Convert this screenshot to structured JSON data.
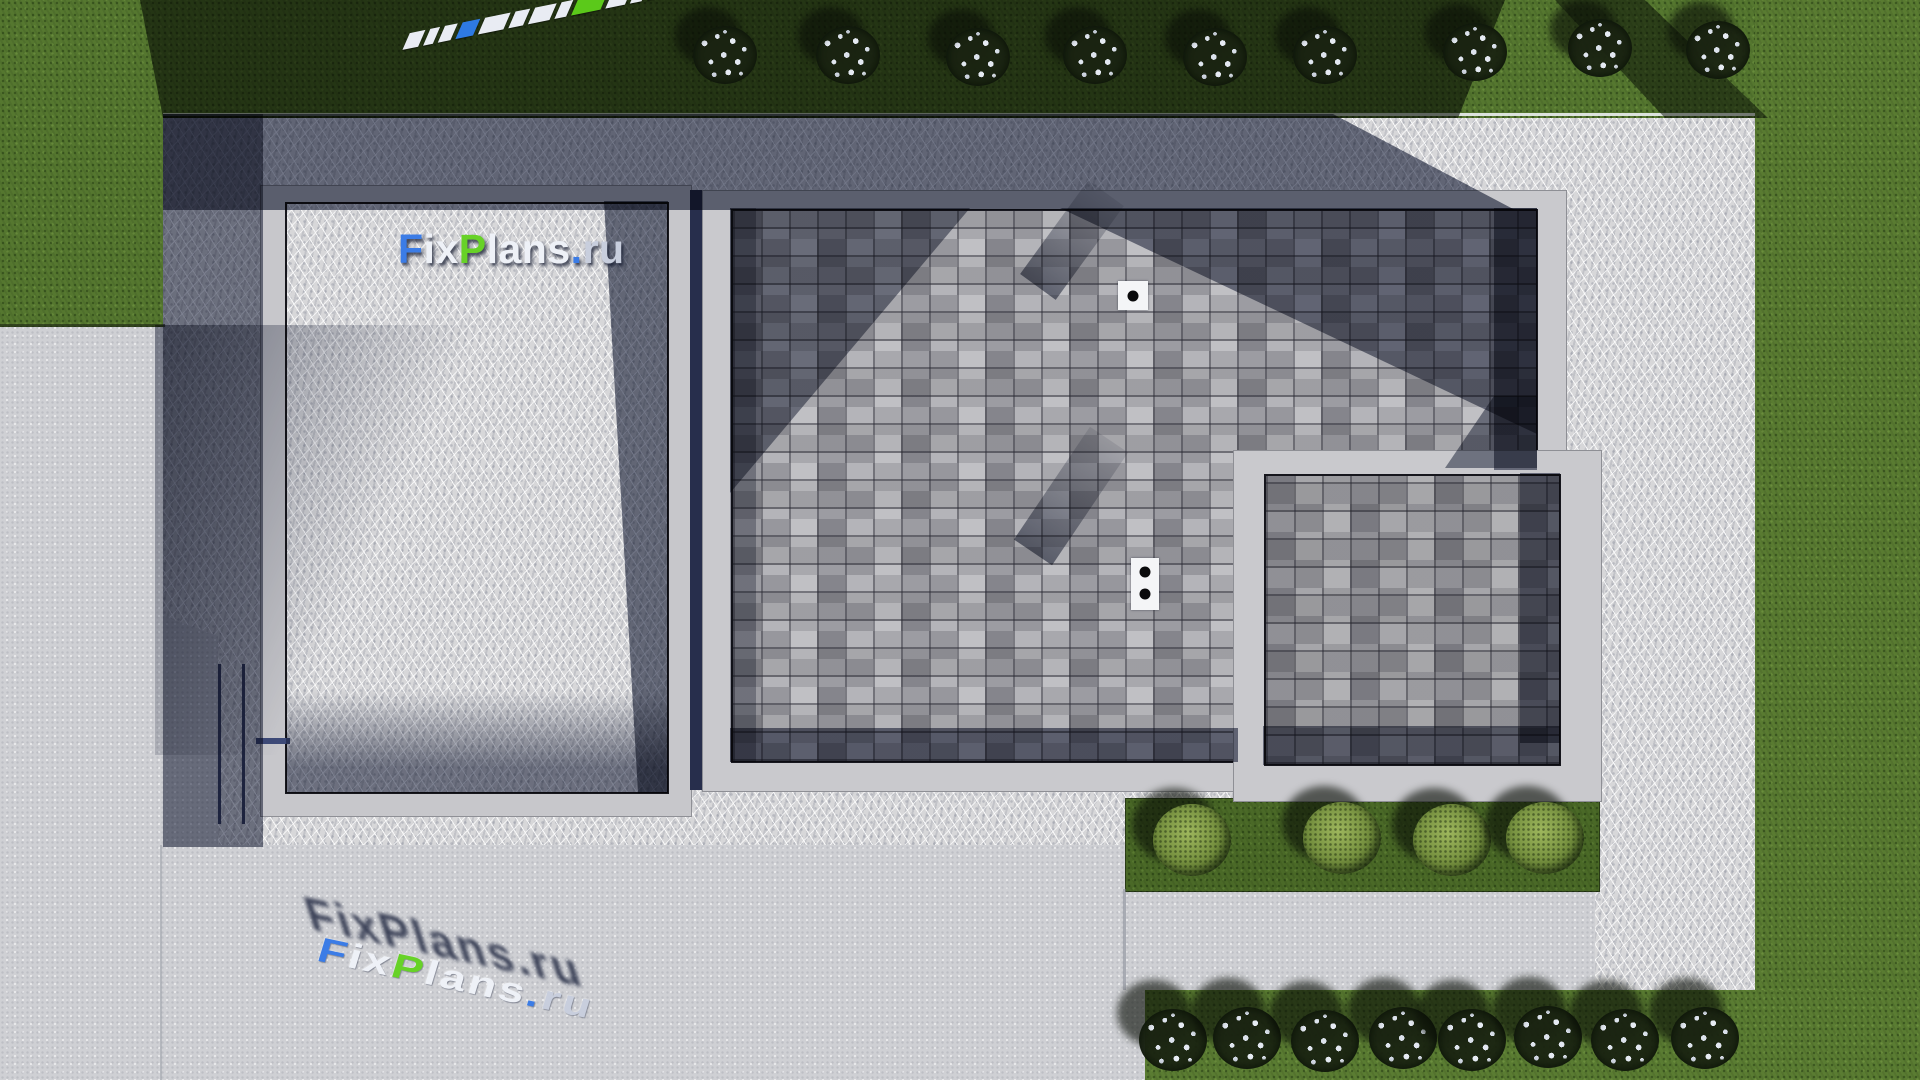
{
  "watermark": {
    "text": "FixPlans.ru",
    "colors": {
      "blue": "#3b7ce6",
      "green": "#67d227",
      "white": "#eef1f7",
      "silver": "#c8cedd",
      "shadow": "rgba(27,34,60,0.82)"
    },
    "segments": [
      {
        "t": "F",
        "c": "blue"
      },
      {
        "t": "ix",
        "c": "white"
      },
      {
        "t": "P",
        "c": "green"
      },
      {
        "t": "lans",
        "c": "white"
      },
      {
        "t": ".",
        "c": "blue"
      },
      {
        "t": "ru",
        "c": "silver"
      }
    ]
  },
  "palette": {
    "grass_sunlit": "#57782f",
    "grass_shadowed": "#202c15",
    "concrete_pavement": "#cfd0d4",
    "gravel_sunlit": "#d8d8da",
    "gravel_shadowed": "#49537a",
    "parapet_wall": "#c7c7cb",
    "paver_light": "#b4b4b9",
    "paver_mid": "#98989e",
    "shadow_blue": "#1f2a4e",
    "vent_white": "#f4f5f7"
  },
  "scene": {
    "flower_bushes_top": [
      {
        "x": 725,
        "y": 55
      },
      {
        "x": 848,
        "y": 55
      },
      {
        "x": 978,
        "y": 57
      },
      {
        "x": 1095,
        "y": 55
      },
      {
        "x": 1215,
        "y": 57
      },
      {
        "x": 1325,
        "y": 55
      },
      {
        "x": 1475,
        "y": 52
      },
      {
        "x": 1600,
        "y": 48
      },
      {
        "x": 1718,
        "y": 50
      }
    ],
    "flower_bushes_bottom": [
      {
        "x": 1173,
        "y": 1040
      },
      {
        "x": 1247,
        "y": 1038
      },
      {
        "x": 1325,
        "y": 1041
      },
      {
        "x": 1403,
        "y": 1038
      },
      {
        "x": 1472,
        "y": 1040
      },
      {
        "x": 1548,
        "y": 1037
      },
      {
        "x": 1625,
        "y": 1040
      },
      {
        "x": 1705,
        "y": 1038
      }
    ],
    "shrubs": [
      {
        "x": 1192,
        "y": 840
      },
      {
        "x": 1342,
        "y": 838
      },
      {
        "x": 1452,
        "y": 840
      },
      {
        "x": 1545,
        "y": 838
      }
    ],
    "vents": [
      {
        "x": 1118,
        "y": 281,
        "w": 30,
        "h": 29,
        "dots": 1
      },
      {
        "x": 1131,
        "y": 558,
        "w": 28,
        "h": 52,
        "dots": 2
      }
    ],
    "strip_colors": {
      "white": "#e9ecf3",
      "blue": "#2e7ae3",
      "green": "#5bc91a"
    },
    "strip_blocks": [
      {
        "w": 16,
        "c": "white"
      },
      {
        "w": 10,
        "c": "white"
      },
      {
        "w": 13,
        "c": "white"
      },
      {
        "w": 18,
        "c": "blue"
      },
      {
        "w": 26,
        "c": "white"
      },
      {
        "w": 15,
        "c": "white"
      },
      {
        "w": 22,
        "c": "white"
      },
      {
        "w": 12,
        "c": "white"
      },
      {
        "w": 30,
        "c": "green"
      },
      {
        "w": 20,
        "c": "white"
      },
      {
        "w": 12,
        "c": "white"
      },
      {
        "w": 15,
        "c": "green"
      },
      {
        "w": 30,
        "c": "blue"
      }
    ]
  }
}
